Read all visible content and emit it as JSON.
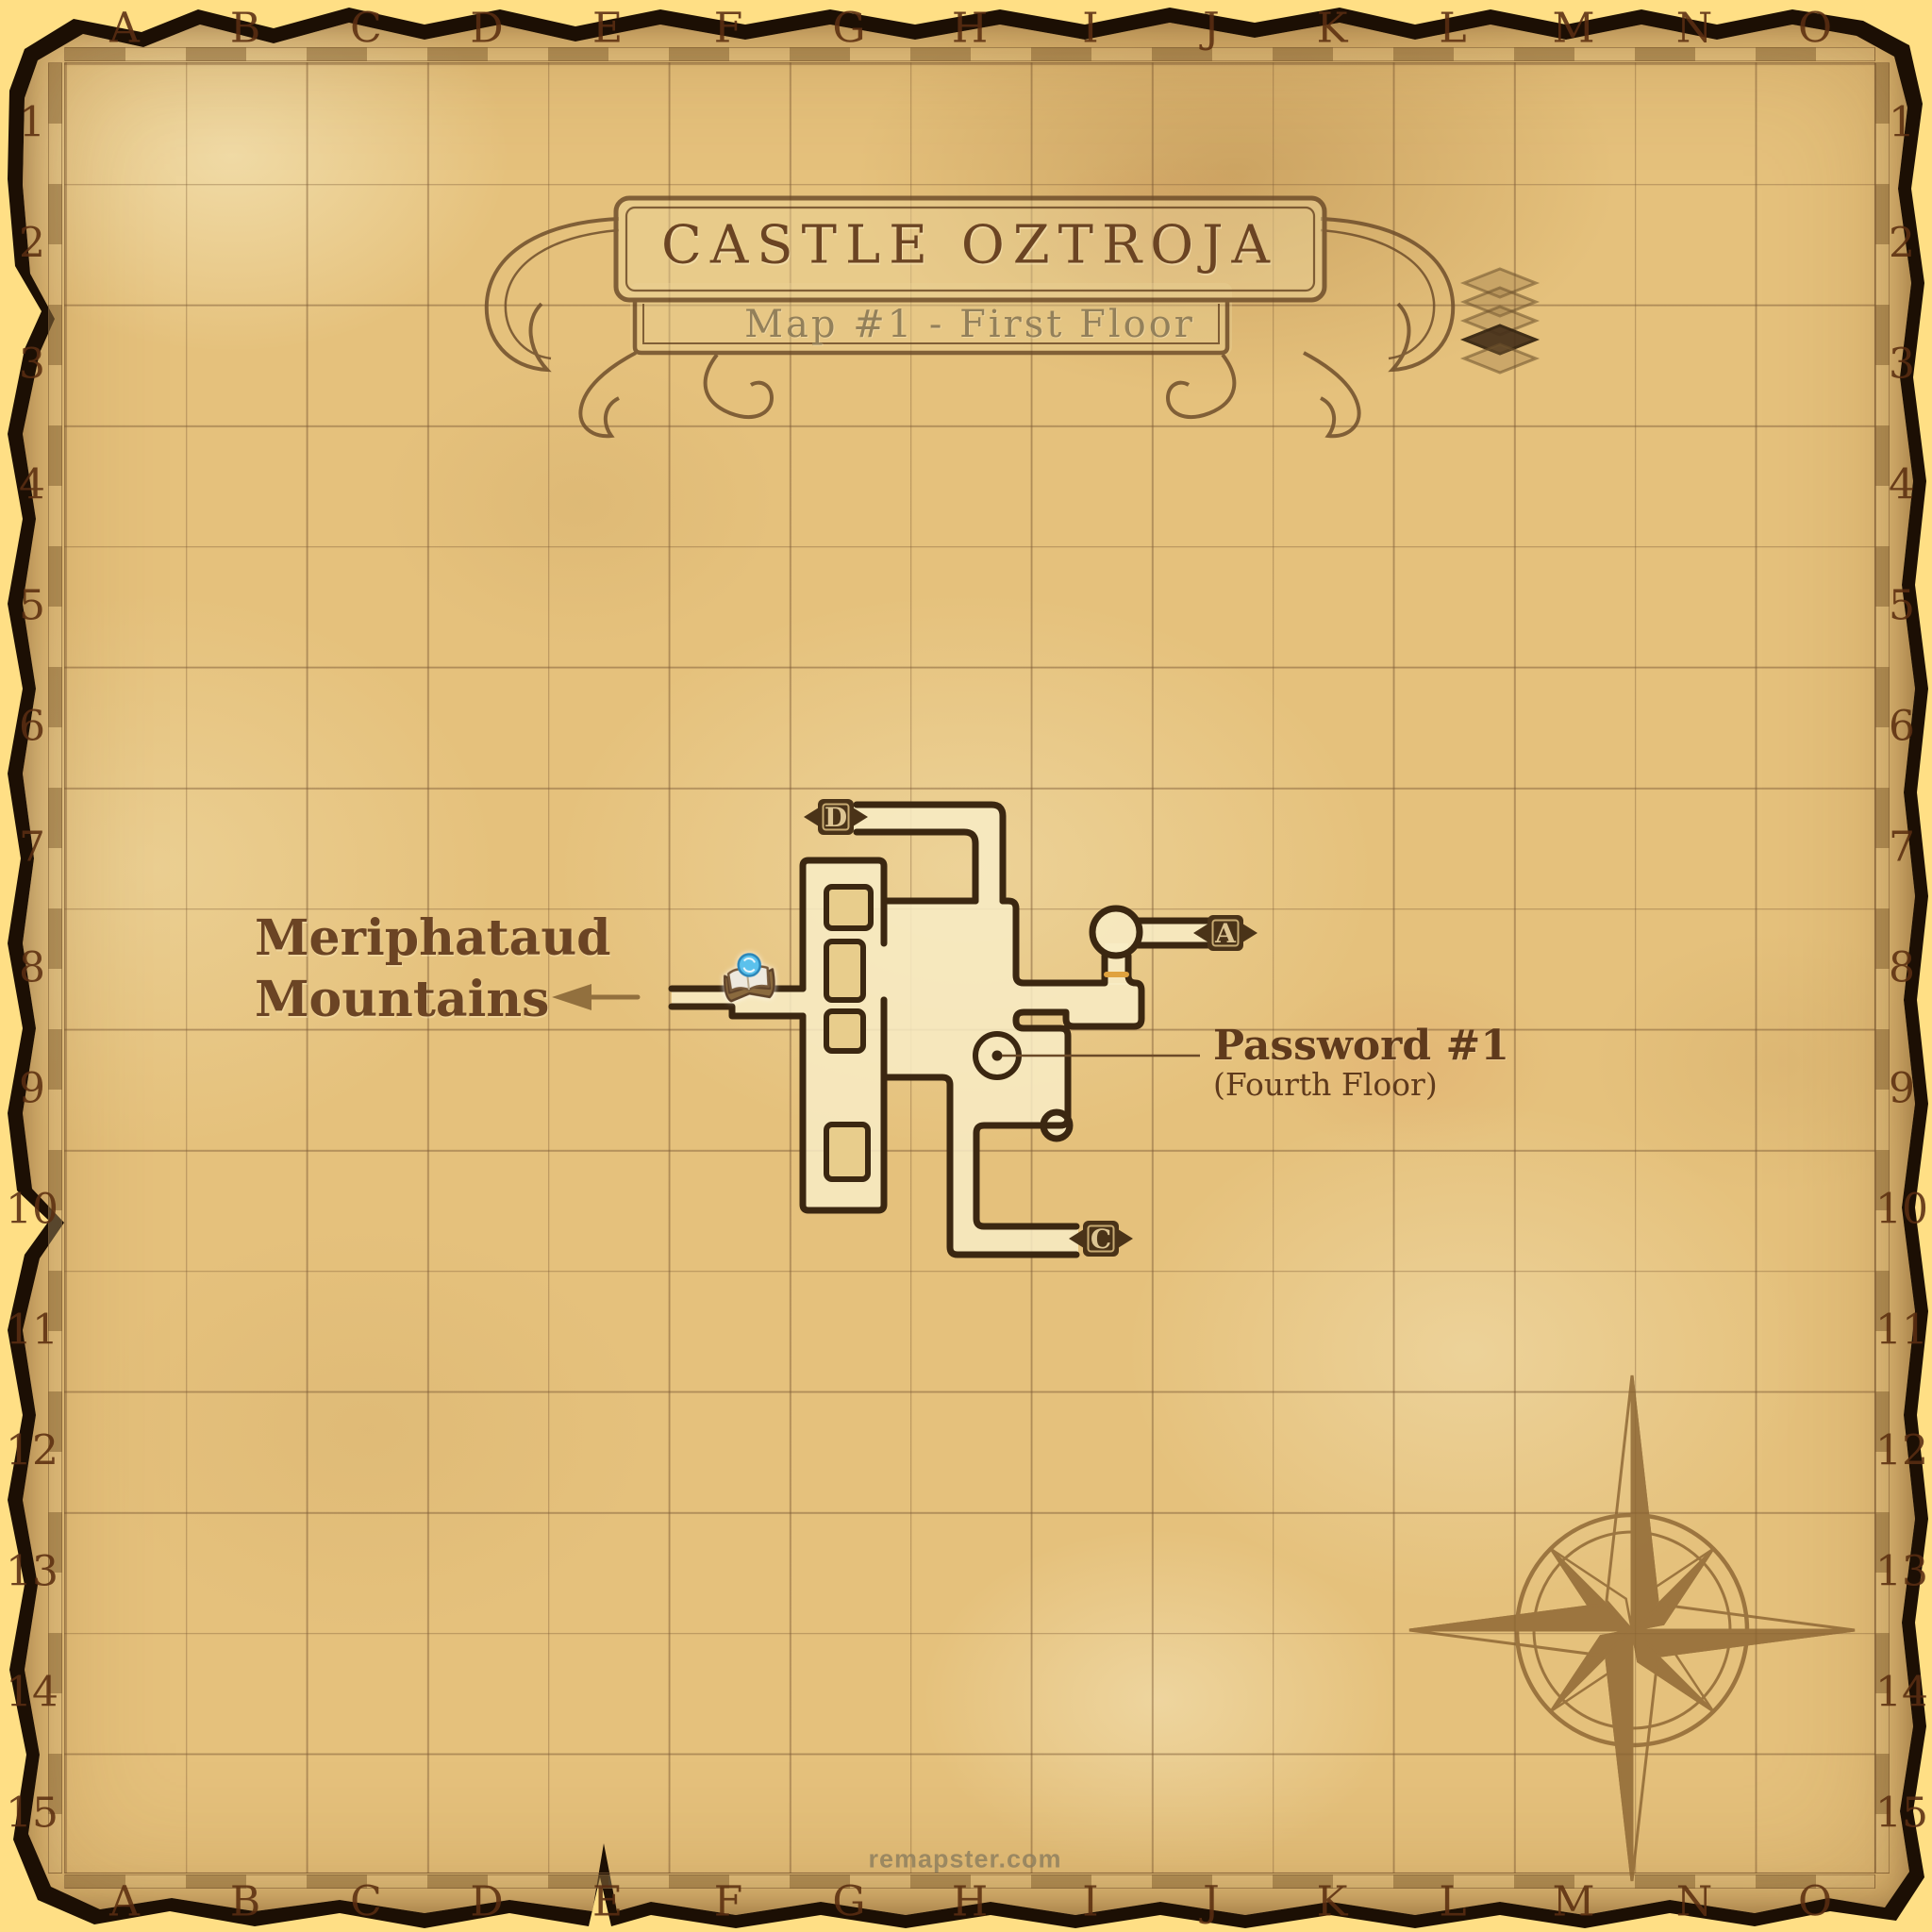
{
  "page": {
    "outer_background": "#ffdf85",
    "watermark": "remapster.com"
  },
  "banner": {
    "title": "CASTLE OZTROJA",
    "subtitle": "Map #1 - First Floor"
  },
  "grid": {
    "columns": [
      "A",
      "B",
      "C",
      "D",
      "E",
      "F",
      "G",
      "H",
      "I",
      "J",
      "K",
      "L",
      "M",
      "N",
      "O"
    ],
    "rows": [
      "1",
      "2",
      "3",
      "4",
      "5",
      "6",
      "7",
      "8",
      "9",
      "10",
      "11",
      "12",
      "13",
      "14",
      "15"
    ]
  },
  "map": {
    "exits": [
      {
        "label": "D"
      },
      {
        "label": "A"
      },
      {
        "label": "C"
      }
    ],
    "west_exit_label": {
      "line1": "Meriphataud",
      "line2": "Mountains"
    },
    "password_label": {
      "title": "Password #1",
      "subtitle": "(Fourth Floor)"
    },
    "icons": {
      "book_marker": "map-book-marker",
      "door": "door-tick",
      "compass": "compass-rose"
    }
  },
  "layer_selector": {
    "levels": 5,
    "active_level": 4
  },
  "colors": {
    "parchment": "#e5c17c",
    "dungeon_wall": "#3b2711",
    "dungeon_floor": "#f8ecc6",
    "ink": "#5a2d12",
    "door_accent": "#e0a23e",
    "compass": "#8a6331",
    "badge": "#4a3318",
    "badge_letter": "#dcc492"
  }
}
